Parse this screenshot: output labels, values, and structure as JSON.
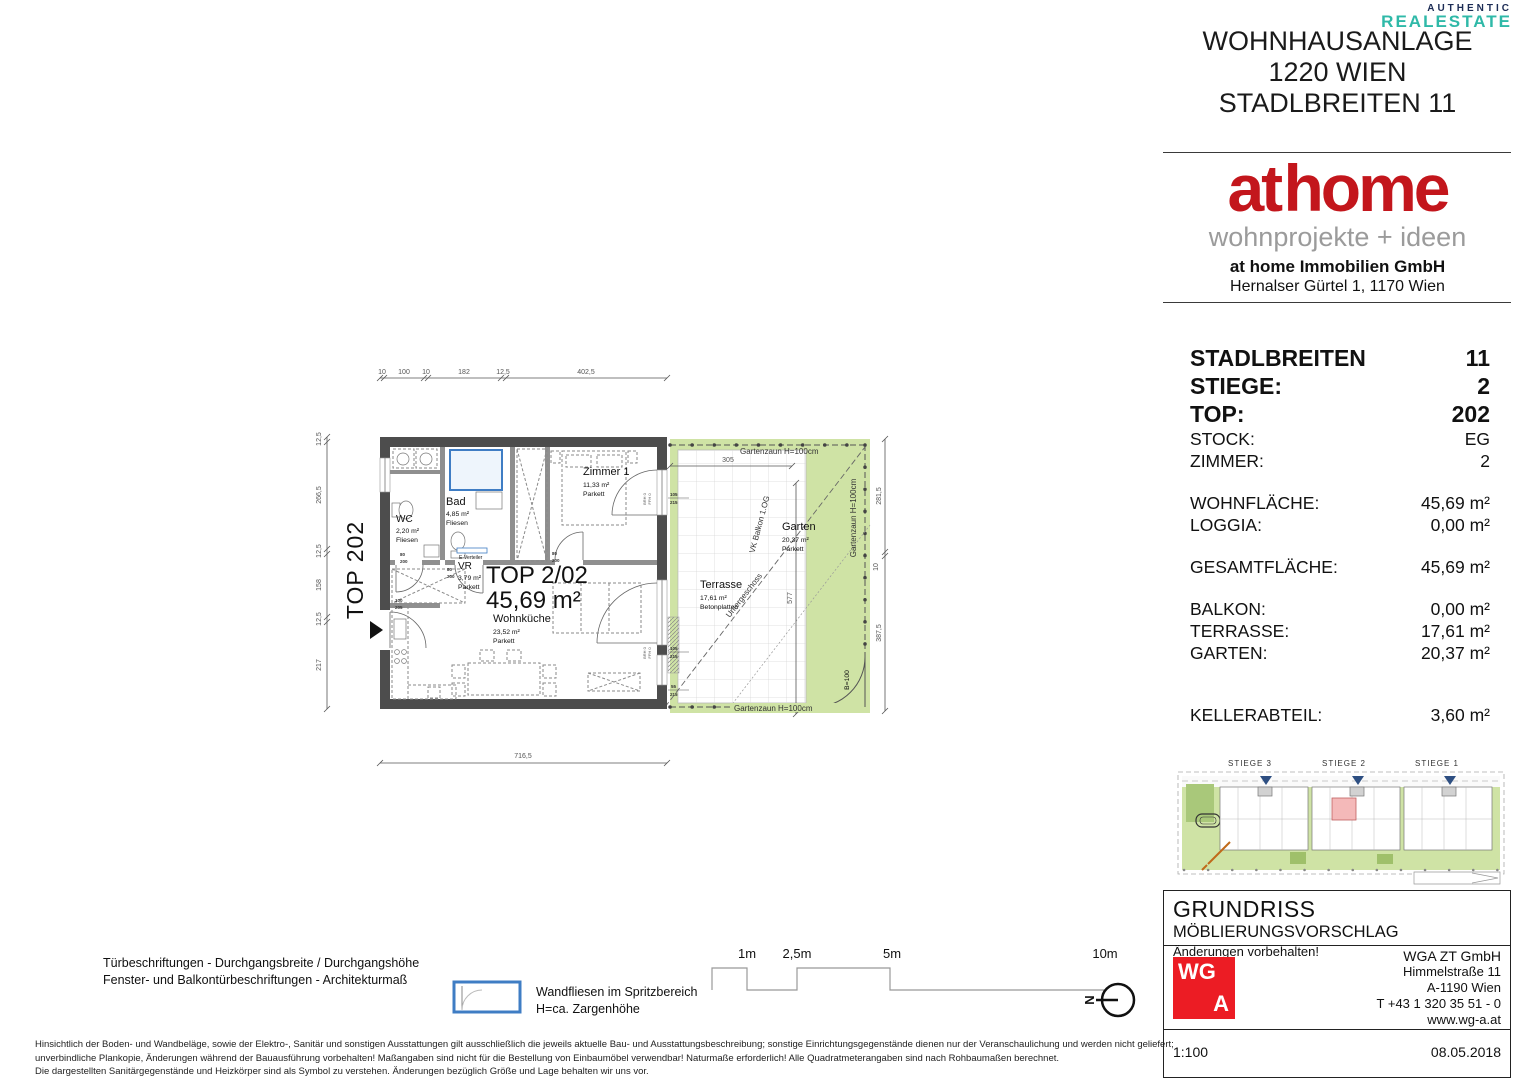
{
  "watermark": {
    "line1": "AUTHENTIC",
    "line2": "REALESTATE"
  },
  "header": {
    "line1": "WOHNHAUSANLAGE",
    "line2": "1220 WIEN",
    "line3": "STADLBREITEN 11"
  },
  "brand": {
    "logo": "at home",
    "tagline": "wohnprojekte + ideen",
    "company": "at home Immobilien GmbH",
    "address": "Hernalser Gürtel 1, 1170 Wien"
  },
  "info": {
    "rows": [
      {
        "label": "STADLBREITEN",
        "value": "11"
      },
      {
        "label": "STIEGE:",
        "value": "2"
      },
      {
        "label": "TOP:",
        "value": "202"
      },
      {
        "label": "STOCK:",
        "value": "EG"
      },
      {
        "label": "ZIMMER:",
        "value": "2"
      },
      {
        "label": "WOHNFLÄCHE:",
        "value": "45,69 m²"
      },
      {
        "label": "LOGGIA:",
        "value": "0,00 m²"
      },
      {
        "label": "GESAMTFLÄCHE:",
        "value": "45,69 m²"
      },
      {
        "label": "BALKON:",
        "value": "0,00 m²"
      },
      {
        "label": "TERRASSE:",
        "value": "17,61 m²"
      },
      {
        "label": "GARTEN:",
        "value": "20,37 m²"
      },
      {
        "label": "KELLERABTEIL:",
        "value": "3,60 m²"
      }
    ]
  },
  "plan": {
    "unit_tag": "TOP 202",
    "unit_name": "TOP 2/02",
    "unit_area": "45,69 m²",
    "rooms": {
      "wc": {
        "name": "WC",
        "area": "2,20 m²",
        "floor": "Fliesen"
      },
      "bad": {
        "name": "Bad",
        "area": "4,85 m²",
        "floor": "Fliesen"
      },
      "vr": {
        "name": "VR",
        "area": "3,79 m²",
        "floor": "Parkett"
      },
      "zimmer1": {
        "name": "Zimmer 1",
        "area": "11,33 m²",
        "floor": "Parkett"
      },
      "wohnkueche": {
        "name": "Wohnküche",
        "area": "23,52 m²",
        "floor": "Parkett"
      },
      "terrasse": {
        "name": "Terrasse",
        "area": "17,61 m²",
        "floor": "Betonplatten"
      },
      "garten": {
        "name": "Garten",
        "area": "20,37 m²",
        "floor": "Parkett"
      }
    },
    "fence_label": "Gartenzaun H=100cm",
    "diag_label1": "VK Balkon 1.OG",
    "diag_label2": "Untergeschoss",
    "gate_label": "B=100",
    "e_verteiler": "E-Verteiler",
    "dims": {
      "top": [
        "10",
        "100",
        "10",
        "182",
        "12,5",
        "402,5"
      ],
      "left": [
        "12,5",
        "266,5",
        "12,5",
        "158",
        "12,5",
        "217"
      ],
      "bottom": "716,5",
      "right": [
        "281,5",
        "10",
        "387,5"
      ],
      "garden_w": "305",
      "garden_h": "577"
    },
    "tags": {
      "w105": "105",
      "w215": "215",
      "w55": "55",
      "d80": "80",
      "d200": "200",
      "d100": "100",
      "d205": "205",
      "brh": "BRH 0",
      "ffh": "FFH 0"
    }
  },
  "siteplan": {
    "labels": [
      "STIEGE 3",
      "STIEGE 2",
      "STIEGE 1"
    ]
  },
  "legend": {
    "door_note1": "Türbeschriftungen - Durchgangsbreite / Durchgangshöhe",
    "door_note2": "Fenster- und Balkontürbeschriftungen - Architekturmaß",
    "tile_note1": "Wandfliesen im Spritzbereich",
    "tile_note2": "H=ca. Zargenhöhe",
    "scale_labels": [
      "1m",
      "2,5m",
      "5m",
      "10m"
    ],
    "north": "N",
    "disclaimer1": "Hinsichtlich der Boden- und Wandbeläge, sowie der Elektro-, Sanitär und sonstigen Ausstattungen gilt ausschließlich die jeweils aktuelle Bau- und Ausstattungsbeschreibung; sonstige Einrichtungsgegenstände dienen nur der Veranschaulichung und werden nicht geliefert;",
    "disclaimer2": "unverbindliche Plankopie, Änderungen während der Bauausführung vorbehalten! Maßangaben sind nicht für die Bestellung von Einbaumöbel verwendbar! Naturmaße erforderlich! Alle Quadratmeterangaben sind nach Rohbaumaßen berechnet.",
    "disclaimer3": "Die dargestellten Sanitärgegenstände und Heizkörper sind als Symbol zu verstehen. Änderungen bezüglich Größe und Lage behalten wir uns vor."
  },
  "titleblock": {
    "title": "GRUNDRISS",
    "subtitle": "MÖBLIERUNGSVORSCHLAG",
    "note": "Änderungen vorbehalten!",
    "logo_top": "WG",
    "logo_bottom": "A",
    "company_lines": [
      "WGA ZT GmbH",
      "Himmelstraße 11",
      "A-1190 Wien",
      "T +43 1 320 35 51 - 0",
      "www.wg-a.at"
    ],
    "scale": "1:100",
    "date": "08.05.2018"
  },
  "colors": {
    "brand_red": "#c3161c",
    "wga_red": "#ec1c24",
    "plan_green": "#cfe3a5",
    "tile_blue": "#3f7dc4",
    "unit_red": "#e0251f",
    "watermark_teal": "#2fb9a8",
    "watermark_navy": "#1c2c55"
  }
}
